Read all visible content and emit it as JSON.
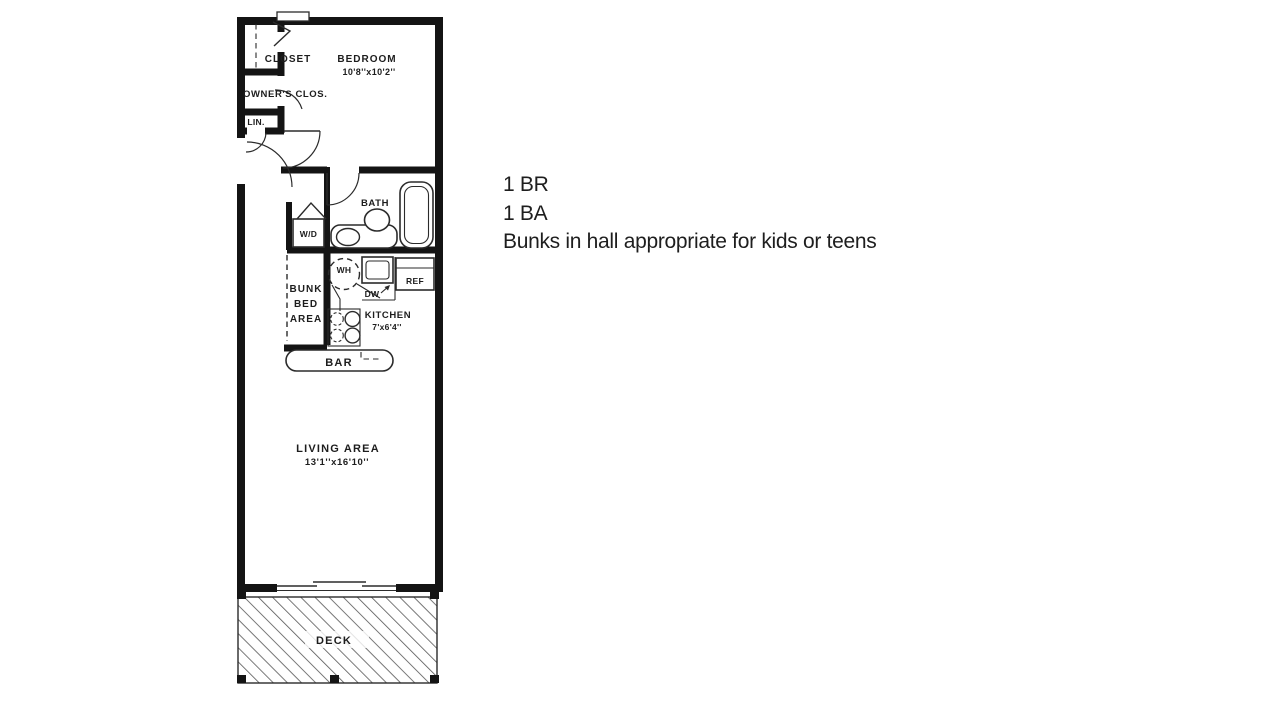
{
  "colors": {
    "page-bg": "#ffffff",
    "wall": "#141414",
    "line": "#2b2b2b",
    "plan-text": "#1d1d1d",
    "hatch": "#555555",
    "annotation-text": "#1e1e1e"
  },
  "annotation": {
    "lines": [
      "1 BR",
      "1 BA",
      "Bunks in hall appropriate for kids or teens"
    ]
  },
  "floor_plan": {
    "labels": {
      "closet": "CLOSET",
      "bedroom_name": "BEDROOM",
      "bedroom_dims": "10'8''x10'2''",
      "owners_closet": "OWNER'S CLOS.",
      "linen": "LIN.",
      "bath": "BATH",
      "washer_dryer": "W/D",
      "water_heater": "WH",
      "dishwasher": "DW",
      "refrigerator": "REF",
      "bunk_line1": "BUNK",
      "bunk_line2": "BED",
      "bunk_line3": "AREA",
      "kitchen_name": "KITCHEN",
      "kitchen_dims": "7'x6'4''",
      "bar": "BAR",
      "living_name": "LIVING AREA",
      "living_dims": "13'1''x16'10''",
      "deck": "DECK"
    }
  }
}
